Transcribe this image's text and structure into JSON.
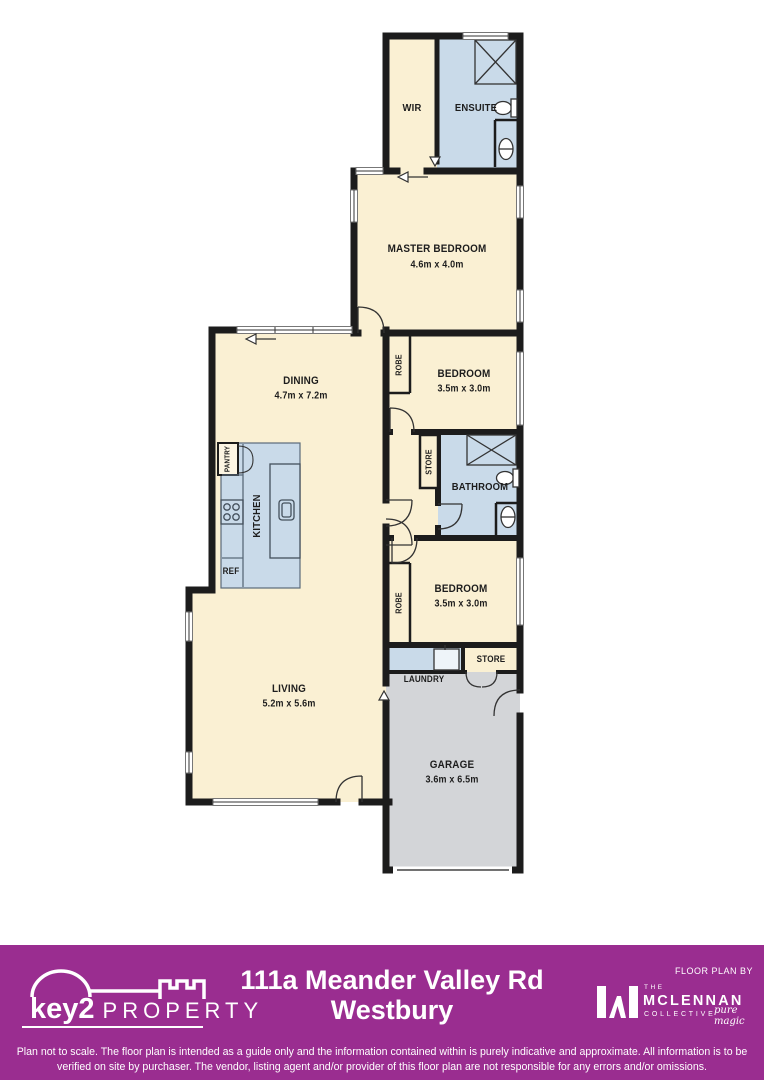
{
  "plan": {
    "rooms": {
      "wir": {
        "label": "WIR"
      },
      "ensuite": {
        "label": "ENSUITE"
      },
      "master": {
        "label": "MASTER BEDROOM",
        "dims": "4.6m x 4.0m"
      },
      "dining": {
        "label": "DINING",
        "dims": "4.7m x 7.2m"
      },
      "bedroom1": {
        "label": "BEDROOM",
        "dims": "3.5m x 3.0m"
      },
      "robe1": {
        "label": "ROBE"
      },
      "store1": {
        "label": "STORE"
      },
      "bathroom": {
        "label": "BATHROOM"
      },
      "pantry": {
        "label": "PANTRY"
      },
      "kitchen": {
        "label": "KITCHEN"
      },
      "ref": {
        "label": "REF"
      },
      "bedroom2": {
        "label": "BEDROOM",
        "dims": "3.5m x 3.0m"
      },
      "robe2": {
        "label": "ROBE"
      },
      "living": {
        "label": "LIVING",
        "dims": "5.2m x 5.6m"
      },
      "laundry": {
        "label": "LAUNDRY"
      },
      "store2": {
        "label": "STORE"
      },
      "garage": {
        "label": "GARAGE",
        "dims": "3.6m x 6.5m"
      }
    },
    "colors": {
      "room": "#FAF0D3",
      "wet_area": "#C9DAE9",
      "garage": "#D3D5D8",
      "wall": "#1C1C1C"
    }
  },
  "footer": {
    "accent": "#9A2D90",
    "brand": {
      "name_bold": "key2",
      "name_light": "PROPERTY"
    },
    "address_line1": "111a Meander Valley Rd",
    "address_line2": "Westbury",
    "floor_plan_by": "FLOOR PLAN BY",
    "provider": {
      "the": "THE",
      "name": "MCLENNAN",
      "collective": "COLLECTIVE",
      "tagline": "pure magic"
    },
    "disclaimer": "Plan not to scale. The floor plan is intended as a guide only and the information contained within is purely indicative and approximate. All information is to be verified on site by purchaser. The vendor, listing agent and/or provider of this floor plan are not responsible for any errors and/or omissions."
  }
}
